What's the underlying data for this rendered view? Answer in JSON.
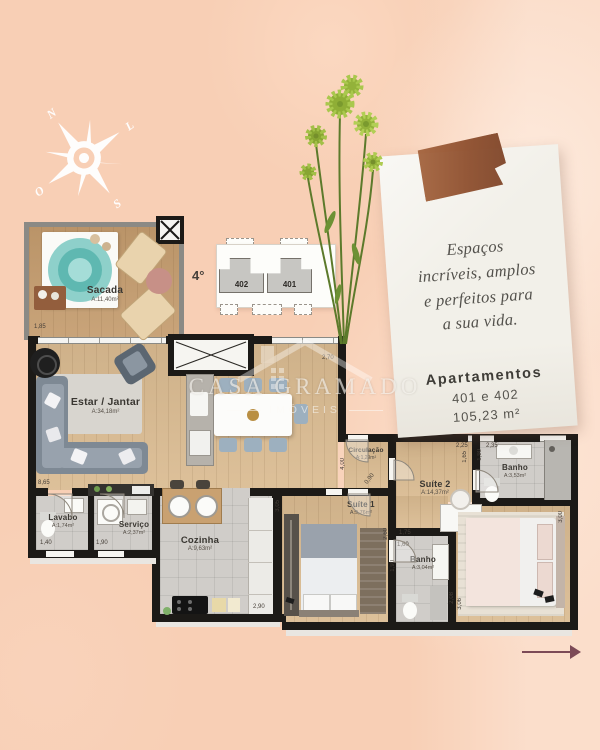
{
  "colors": {
    "background": "#f8cfb5",
    "wall": "#1c1a17",
    "wood_floor": "#dabb91",
    "tile_floor": "#d0cdc9",
    "tape": "#9c5c3b",
    "hot_tub": "#6fc2bc",
    "paper": "#f2f0e9",
    "arrow": "#7c4a57"
  },
  "compass": {
    "north": "N",
    "east": "L",
    "south": "S",
    "west": "O"
  },
  "key_plan": {
    "floor_label": "4°",
    "unit_left": "402",
    "unit_right": "401"
  },
  "note_card": {
    "script_lines": [
      "Espaços",
      "incríveis, amplos",
      "e perfeitos para",
      "a sua vida."
    ],
    "title": "Apartamentos",
    "units_line": "401 e 402",
    "area_line": "105,23 m²"
  },
  "watermark": {
    "brand": "CASA GRAMADO",
    "sub": "IMÓVEIS"
  },
  "rooms": [
    {
      "name": "Sacada",
      "area": "A:11,40m²"
    },
    {
      "name": "Estar / Jantar",
      "area": "A:34,18m²"
    },
    {
      "name": "Lavabo",
      "area": "A:1,74m²"
    },
    {
      "name": "Serviço",
      "area": "A:2,37m²"
    },
    {
      "name": "Cozinha",
      "area": "A:9,63m²"
    },
    {
      "name": "Circulação",
      "area": "A:1,29m²"
    },
    {
      "name": "Suíte 1",
      "area": "A:9,76m²"
    },
    {
      "name": "Banho",
      "area": "A:3,04m²"
    },
    {
      "name": "Suíte 2",
      "area": "A:14,37m²"
    },
    {
      "name": "Banho",
      "area": "A:3,53m²"
    }
  ],
  "dimensions": {
    "sacada": "1,85",
    "living": "8,65",
    "dining": "2,70",
    "lavabo": "1,40",
    "servico": "1,90",
    "cozinha": "2,90",
    "suite1": "3,05",
    "circ_len": "4,00",
    "circ_door": "0,90",
    "banho1_len": "2,60",
    "banho1_w": "1,75",
    "banho1_w2": "1,60",
    "banho1_side": "1,90",
    "banho2_w": "2,25",
    "banho2_side": "1,65",
    "banho2_side2": "1,90",
    "banho2_w2": "2,35",
    "suite2_side": "3,00",
    "suite2_side2": "2,08",
    "suite2_side3": "3,06"
  }
}
